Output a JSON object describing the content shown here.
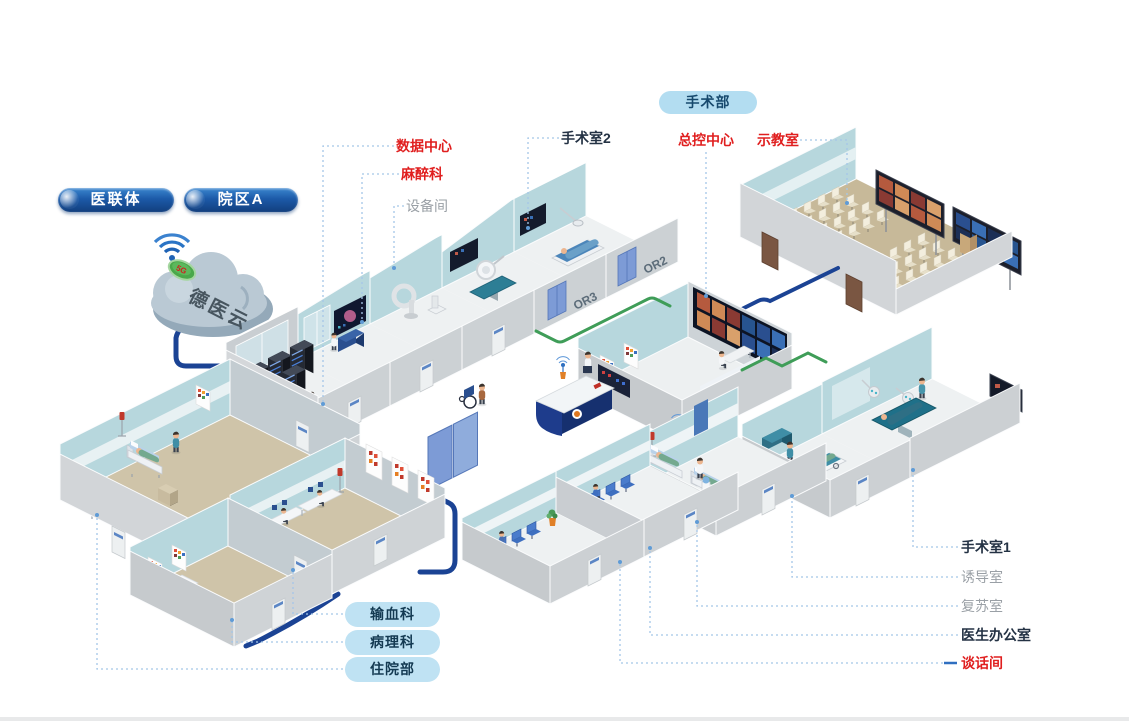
{
  "cloud": {
    "name": "德医云",
    "badge": "5G"
  },
  "org_badges": {
    "consortium": "医联体",
    "campus_a": "院区A"
  },
  "department_badge": {
    "surgery_dept": "手术部"
  },
  "room_labels": {
    "data_center": "数据中心",
    "anesthesiology": "麻醉科",
    "equipment_room": "设备间",
    "operating_room_2": "手术室2",
    "master_control_center": "总控中心",
    "demo_classroom": "示教室",
    "operating_room_1": "手术室1",
    "induction_room": "诱导室",
    "recovery_room": "复苏室",
    "doctor_office": "医生办公室",
    "talk_room": "谈话间"
  },
  "department_pills": {
    "blood_transfusion": "输血科",
    "pathology": "病理科",
    "inpatient_dept": "住院部"
  },
  "wall_tags": {
    "or2": "OR2",
    "or3": "OR3"
  },
  "colors": {
    "label_red": "#e01f1f",
    "label_dark": "#243244",
    "label_gray": "#9aa0a6",
    "pill_dark_blue": "#1c5aa8",
    "pill_light_blue": "#b3ddf1",
    "pill_sky_blue": "#bfe2f3",
    "cable_navy": "#1b4394",
    "cable_green": "#3f9d58",
    "wall_teal": "#b7d7dd",
    "floor_tan": "#ccc0a3",
    "cloud_gray": "#b6c7d3",
    "badge_green": "#4aa84a",
    "leader_blue": "#a5c6e8"
  }
}
